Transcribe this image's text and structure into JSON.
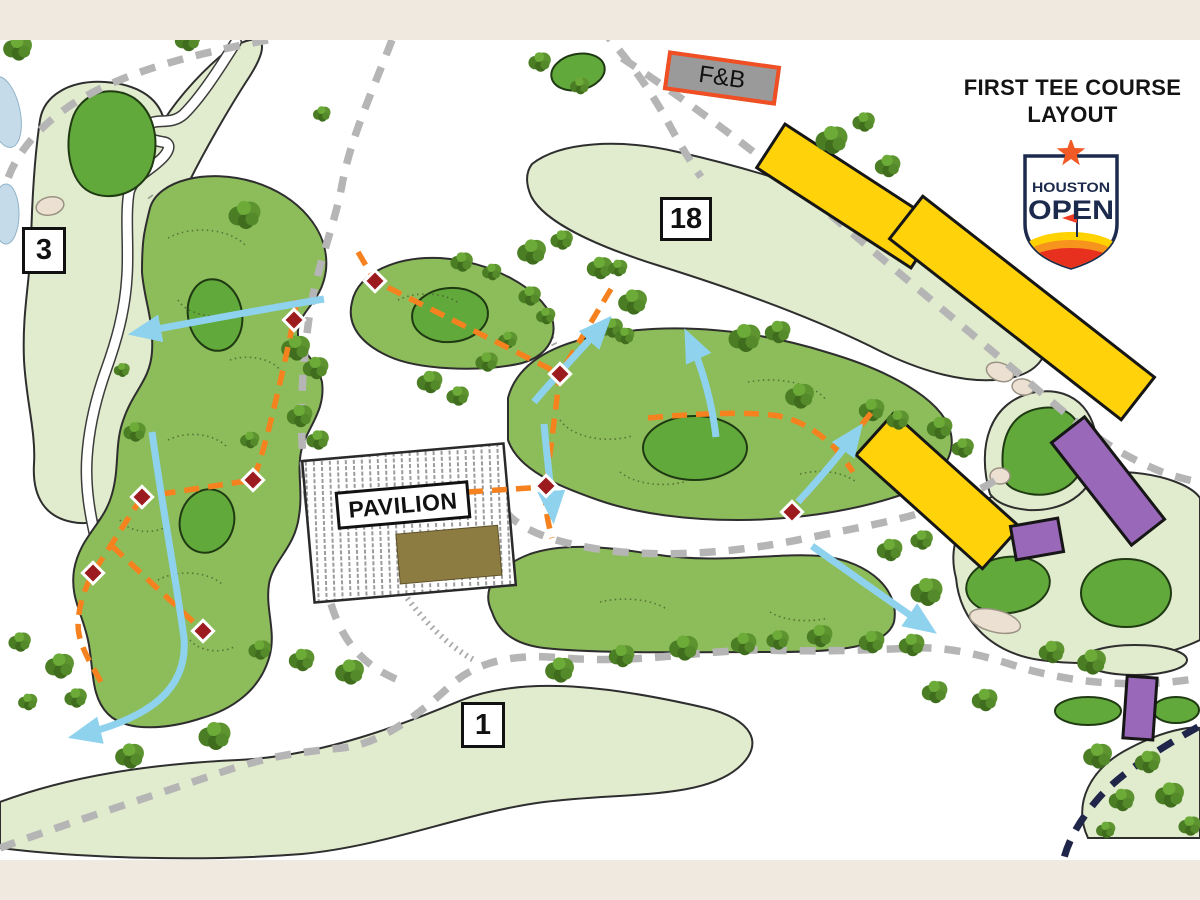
{
  "map": {
    "title_line1": "FIRST TEE COURSE",
    "title_line2": "LAYOUT",
    "logo": {
      "line1": "HOUSTON",
      "line2": "OPEN"
    },
    "labels": {
      "fnb": "F&B",
      "pavilion": "PAVILION"
    },
    "hole_markers": [
      {
        "number": "3"
      },
      {
        "number": "18"
      },
      {
        "number": "1"
      }
    ],
    "colors": {
      "background_cream": "#efe9df",
      "map_white": "#ffffff",
      "fairway_light": "#e1ebcd",
      "green_medium": "#8dbd5a",
      "green_dark": "#62a93c",
      "stand_yellow": "#ffd20a",
      "stand_purple": "#9a68b8",
      "route_orange": "#f5821f",
      "arrow_blue": "#8ed2ee",
      "path_gray": "#b5b5b5",
      "path_navy": "#20254a",
      "marker_red": "#9b1b1e",
      "bunker_sand": "#ece0d2",
      "water_blue": "#c6dbe9",
      "fnb_fill": "#9a9a9a",
      "fnb_border": "#f04e23",
      "building_khaki": "#8d7c42",
      "logo_navy": "#1c2b4d",
      "logo_orange": "#f15a24",
      "outline_dark": "#2e2e2e"
    }
  }
}
